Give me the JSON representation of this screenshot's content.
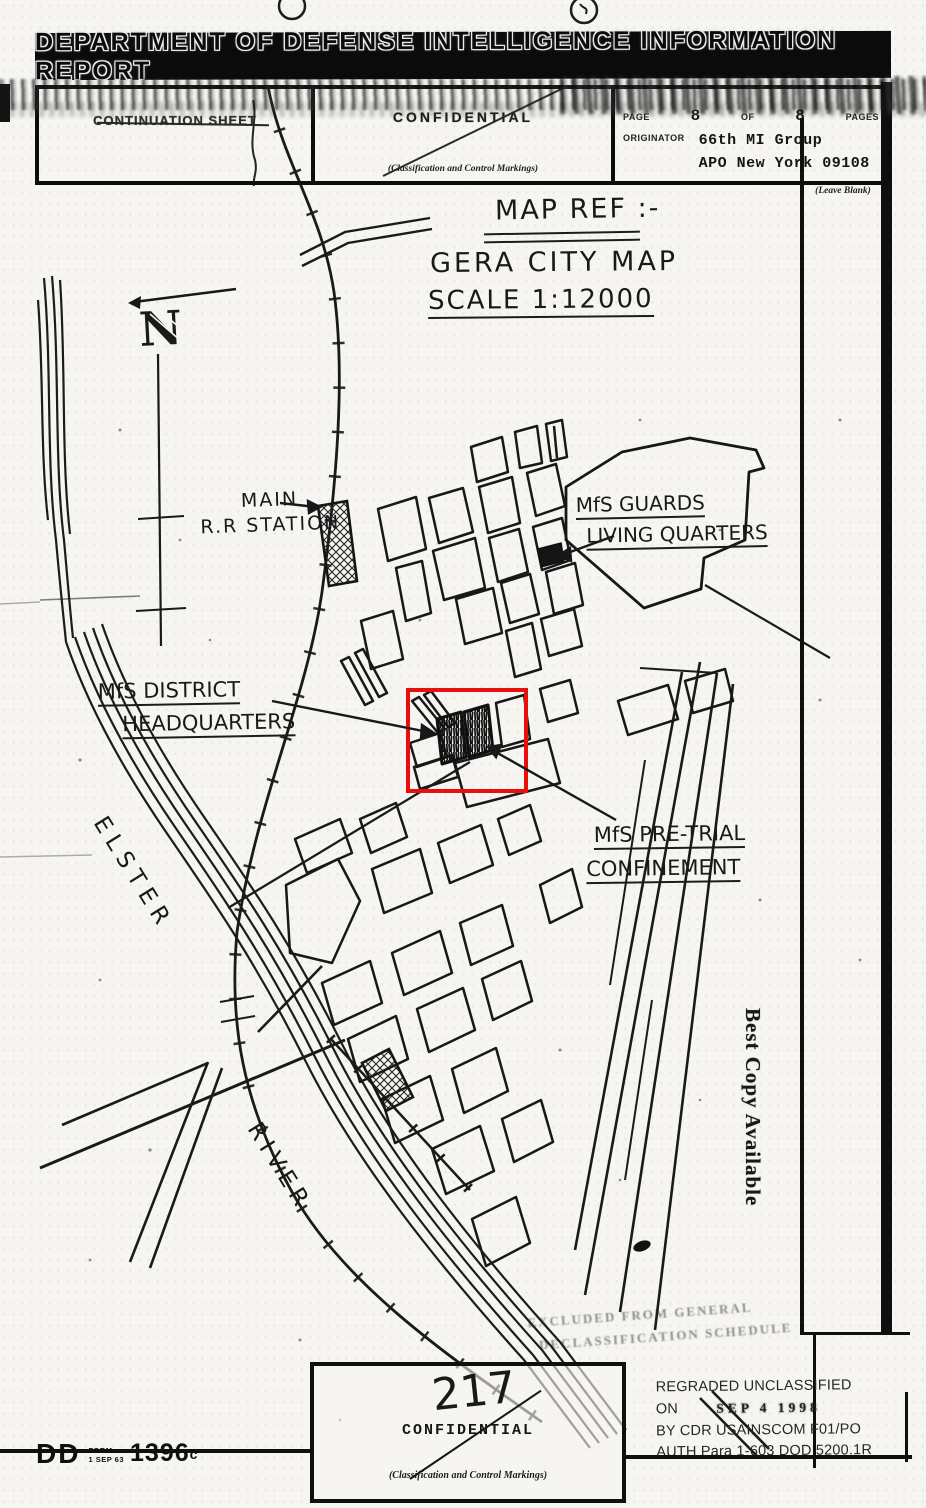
{
  "banner": {
    "title": "DEPARTMENT OF DEFENSE INTELLIGENCE INFORMATION REPORT"
  },
  "header": {
    "continuation_sheet": "CONTINUATION SHEET",
    "classification": "CONFIDENTIAL",
    "classification_caption": "(Classification and Control Markings)",
    "page_label": "PAGE",
    "page_current": "8",
    "of_label": "OF",
    "page_total": "8",
    "pages_label": "PAGES",
    "originator_label": "ORIGINATOR",
    "originator_unit": "66th MI Group",
    "originator_address": "APO New York 09108",
    "leave_blank": "(Leave Blank)"
  },
  "map": {
    "title": "MAP REF :-",
    "subtitle": "GERA CITY MAP",
    "scale": "SCALE 1:12000",
    "north_label": "N",
    "highlight_color": "#e8100c",
    "labels": {
      "station_line1": "MAIN",
      "station_line2": "R.R STATION",
      "guards_line1": "MfS GUARDS",
      "guards_line2": "LIVING QUARTERS",
      "hq_line1": "MfS DISTRICT",
      "hq_line2": "HEADQUARTERS",
      "pretrial_line1": "MfS PRE-TRIAL",
      "pretrial_line2": "CONFINEMENT",
      "river_line1": "ELSTER",
      "river_line2": "RIVER"
    }
  },
  "watermark": {
    "text": "Best Copy Available"
  },
  "stamps": {
    "excluded_line1": "EXCLUDED FROM GENERAL",
    "excluded_line2": "DECLASSIFICATION SCHEDULE",
    "regraded_line1": "REGRADED UNCLASSIFIED",
    "regraded_on": "ON",
    "regraded_date": "SEP 4 1998",
    "regraded_by": "BY CDR USAINSCOM F01/PO",
    "regraded_auth": "AUTH Para 1-603 DOD 5200.1R"
  },
  "footer": {
    "page_number": "217",
    "classification": "CONFIDENTIAL",
    "classification_caption": "(Classification and Control Markings)",
    "form_prefix": "DD",
    "form_label": "FORM",
    "form_date": "1 SEP 63",
    "form_number": "1396",
    "form_suffix": "c"
  }
}
